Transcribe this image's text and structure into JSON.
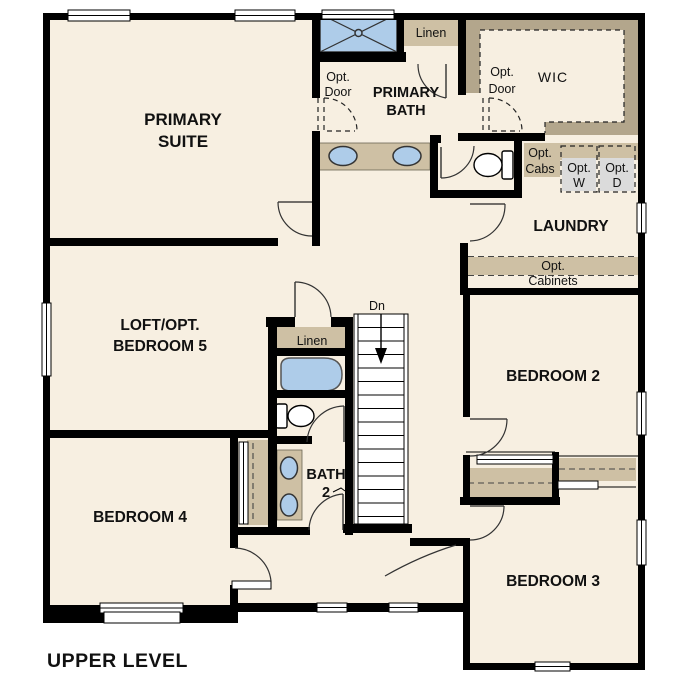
{
  "title": "UPPER LEVEL",
  "colors": {
    "wall": "#000000",
    "floor": "#f7efe1",
    "counter_tan": "#cec0a4",
    "wic_tan": "#b3a68c",
    "fixture_blue": "#aecce9",
    "appliance_gray": "#dbdbdb",
    "outline": "#333333",
    "background": "#ffffff"
  },
  "rooms": {
    "primary_suite": {
      "line1": "PRIMARY",
      "line2": "SUITE"
    },
    "primary_bath": {
      "line1": "PRIMARY",
      "line2": "BATH"
    },
    "wic": {
      "label": "WIC"
    },
    "laundry": {
      "label": "LAUNDRY"
    },
    "loft": {
      "line1": "LOFT/OPT.",
      "line2": "BEDROOM 5"
    },
    "bedroom2": {
      "label": "BEDROOM 2"
    },
    "bedroom3": {
      "label": "BEDROOM 3"
    },
    "bedroom4": {
      "label": "BEDROOM 4"
    },
    "bath2": {
      "line1": "BATH",
      "line2": "2"
    }
  },
  "features": {
    "linen_upper": "Linen",
    "linen_hall": "Linen",
    "opt_door_bath": {
      "line1": "Opt.",
      "line2": "Door"
    },
    "opt_door_wic": {
      "line1": "Opt.",
      "line2": "Door"
    },
    "opt_cabs": {
      "line1": "Opt.",
      "line2": "Cabs"
    },
    "opt_washer": {
      "line1": "Opt.",
      "line2": "W"
    },
    "opt_dryer": {
      "line1": "Opt.",
      "line2": "D"
    },
    "opt_cabinets": {
      "line1": "Opt.",
      "line2": "Cabinets"
    },
    "stairs_down": "Dn"
  }
}
